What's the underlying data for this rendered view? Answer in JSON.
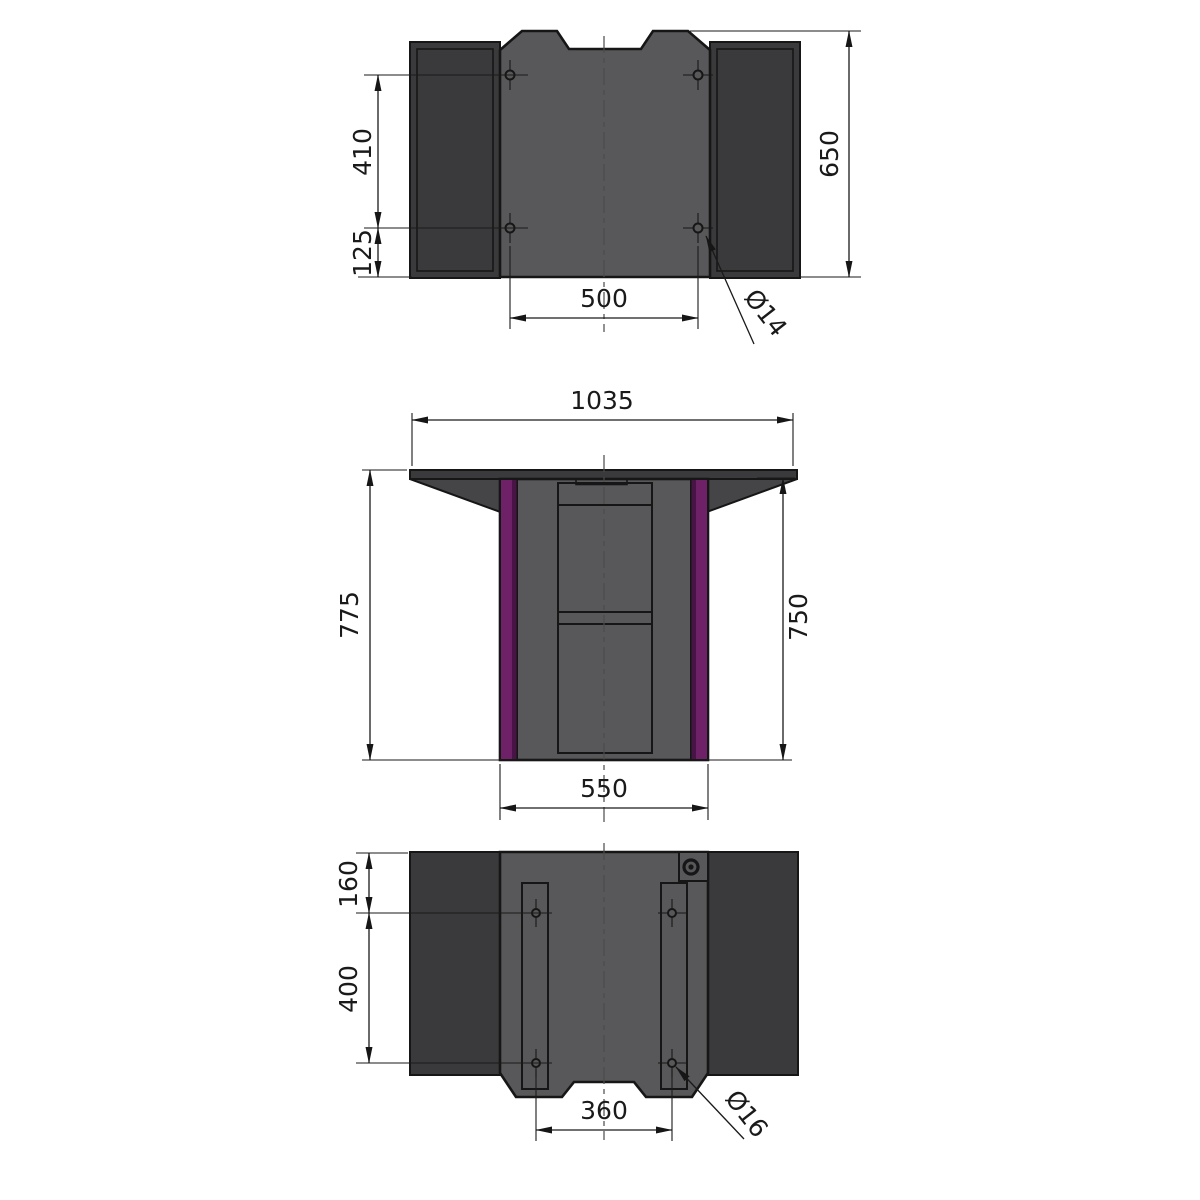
{
  "colors": {
    "background": "#ffffff",
    "outline": "#161616",
    "dim": "#1a1a1a",
    "centerline": "#4a4a4a",
    "panel_dark": "#3a3a3c",
    "panel_mid": "#58585a",
    "wing": "#454548",
    "purple": "#6f2168",
    "purple_dark": "#471445"
  },
  "views": {
    "top": {
      "dim_vertical_hole_spacing": "410",
      "dim_hole_to_edge": "125",
      "dim_overall": "650",
      "dim_horizontal_hole_spacing": "500",
      "hole_diameter": "Ø14"
    },
    "front": {
      "dim_top_width": "1035",
      "dim_overall_height": "775",
      "dim_column_height": "750",
      "dim_base_width": "550"
    },
    "bottom": {
      "dim_edge_to_hole": "160",
      "dim_vertical_hole_spacing": "400",
      "dim_horizontal_hole_spacing": "360",
      "hole_diameter": "Ø16"
    }
  }
}
